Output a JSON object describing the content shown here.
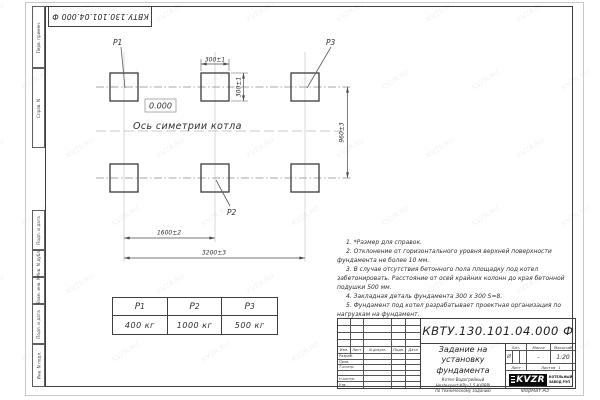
{
  "watermark": {
    "text": "KVZR.RU"
  },
  "stamp_top": "КВТУ.130.101.04.000  Ф",
  "frame": {
    "left_labels": [
      "Перв. примен.",
      "Справ. N",
      "Подп. и дата",
      "Инв. N дубл.",
      "Взам. инв. N",
      "Подп. и дата",
      "Инв. N подл."
    ],
    "format_label": "Формат А3"
  },
  "colors": {
    "ink": "#3a3a3a",
    "axis_gray": "#b8b8b8",
    "logo_black": "#0a0a0a"
  },
  "drawing": {
    "point_labels": {
      "p1": "P1",
      "p2": "P2",
      "p3": "P3"
    },
    "elevation": "0.000",
    "axis_caption": "Ось симетрии котла",
    "dims": {
      "pad_width": "300±1",
      "pad_height": "300±1",
      "row_spacing": "960±3",
      "col_spacing": "1600±2",
      "total_span": "3200±3"
    }
  },
  "load_table": {
    "cols": [
      {
        "sym": "P",
        "sub": "1",
        "value": "400 кг"
      },
      {
        "sym": "P",
        "sub": "2",
        "value": "1000 кг"
      },
      {
        "sym": "P",
        "sub": "3",
        "value": "500 кг"
      }
    ]
  },
  "notes": {
    "lines": [
      "1. *Размер для справок.",
      "2. Отклонение от горизонтального уровня верхней поверхности фундамента не более 10 мм.",
      "3. В случае отсутствия бетонного пола площадку под котел забетонировать. Расстояние от осей крайних колонн до края бетонной подушки 500 мм.",
      "4. Закладная деталь фундамента 300 x 300 S=8.",
      "5. Фундамент под котел разрабатывает проектная организация по нагрузкам на фундамент."
    ]
  },
  "title_block": {
    "doc_number": "КВТУ.130.101.04.000  Ф",
    "title_lines": [
      "Задание на",
      "установку",
      "фундамента"
    ],
    "subtitle_lines": [
      "Котел Водогрейный",
      "Heatexpert-КВр-1,5-К(РВР)",
      "по техническому заданию"
    ],
    "header_cols": [
      "Изм.",
      "Лист",
      "N докум.",
      "Подп.",
      "Дата"
    ],
    "approval_rows": [
      "Разраб.",
      "Пров.",
      "Т.контр.",
      "",
      "Н.контр.",
      "Утв."
    ],
    "lit": {
      "label": "Лит.",
      "value": "И"
    },
    "mass": {
      "label": "Масса",
      "value": "-"
    },
    "scale": {
      "label": "Масштаб",
      "value": "1:20"
    },
    "sheet": {
      "label": "Лист",
      "total_label": "Листов",
      "total_value": "1"
    },
    "logo": {
      "text": "KVZR",
      "company_lines": [
        "КОТЕЛЬНЫЙ",
        "ЗАВОД РЭП"
      ]
    }
  }
}
